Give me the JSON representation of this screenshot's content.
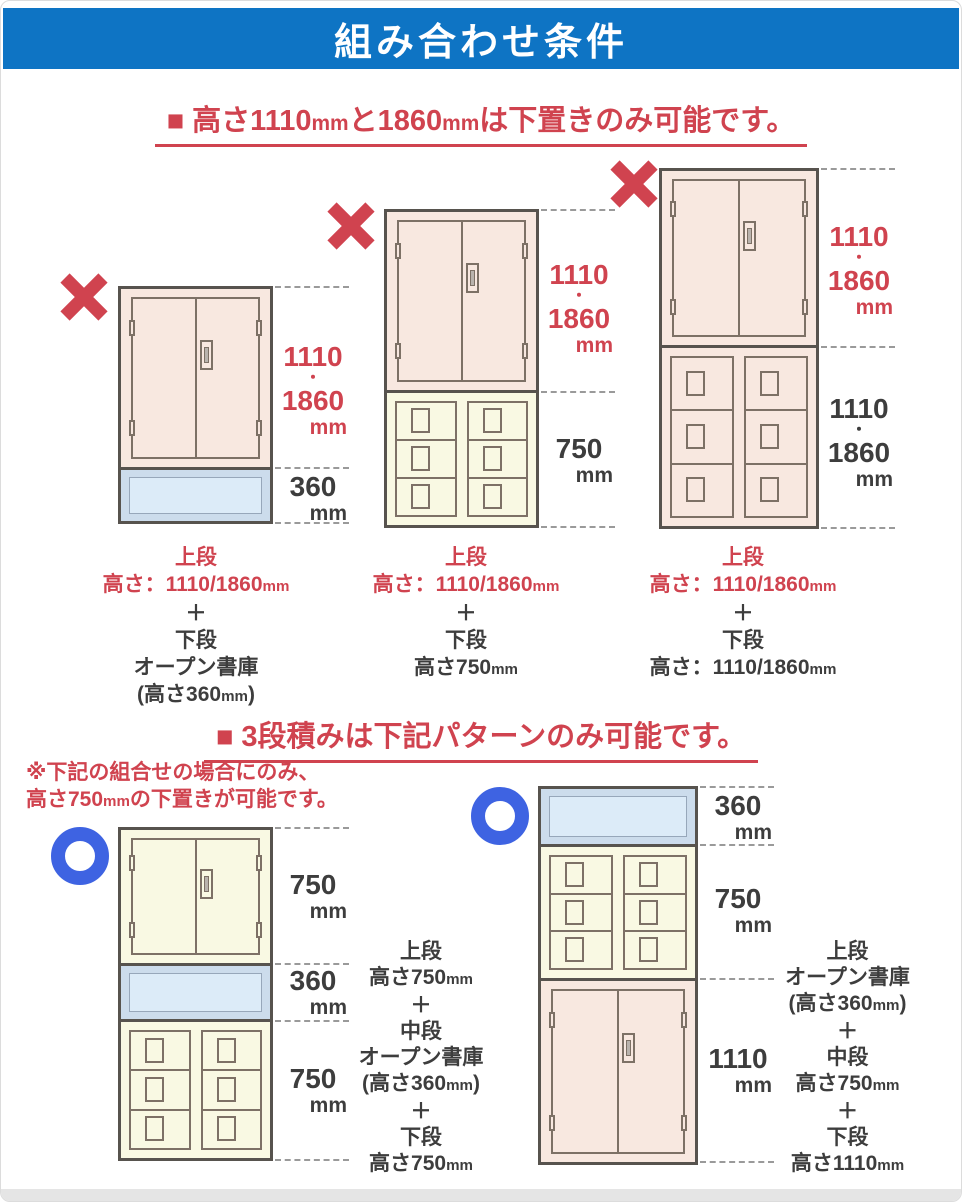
{
  "title": "組み合わせ条件",
  "colors": {
    "header_bg": "#0e74c4",
    "ng_red": "#d0434f",
    "ok_blue": "#3e63e2",
    "text_dark": "#3d3d3d"
  },
  "icons": {
    "ng_mark": "x-cross",
    "ok_mark": "circle-ring"
  },
  "section1": {
    "heading": "■ 高さ1110mmと1860mmは下置きのみ可能です。",
    "diagrams": [
      {
        "mark": "ng",
        "dims": [
          {
            "lines": [
              "1110",
              "・",
              "1860",
              "mm"
            ],
            "color": "red"
          },
          {
            "lines": [
              "360",
              "mm"
            ],
            "color": "dark"
          }
        ],
        "caption": [
          {
            "text": "上段",
            "color": "red"
          },
          {
            "text": "高さ：1110/1860mm",
            "color": "red"
          },
          {
            "text": "＋",
            "color": "dark"
          },
          {
            "text": "下段",
            "color": "dark"
          },
          {
            "text": "オープン書庫",
            "color": "dark"
          },
          {
            "text": "(高さ360mm)",
            "color": "dark"
          }
        ]
      },
      {
        "mark": "ng",
        "dims": [
          {
            "lines": [
              "1110",
              "・",
              "1860",
              "mm"
            ],
            "color": "red"
          },
          {
            "lines": [
              "750",
              "mm"
            ],
            "color": "dark"
          }
        ],
        "caption": [
          {
            "text": "上段",
            "color": "red"
          },
          {
            "text": "高さ：1110/1860mm",
            "color": "red"
          },
          {
            "text": "＋",
            "color": "dark"
          },
          {
            "text": "下段",
            "color": "dark"
          },
          {
            "text": "高さ750mm",
            "color": "dark"
          }
        ]
      },
      {
        "mark": "ng",
        "dims": [
          {
            "lines": [
              "1110",
              "・",
              "1860",
              "mm"
            ],
            "color": "red"
          },
          {
            "lines": [
              "1110",
              "・",
              "1860",
              "mm"
            ],
            "color": "dark"
          }
        ],
        "caption": [
          {
            "text": "上段",
            "color": "red"
          },
          {
            "text": "高さ：1110/1860mm",
            "color": "red"
          },
          {
            "text": "＋",
            "color": "dark"
          },
          {
            "text": "下段",
            "color": "dark"
          },
          {
            "text": "高さ：1110/1860mm",
            "color": "dark"
          }
        ]
      }
    ]
  },
  "section2": {
    "heading": "■ 3段積みは下記パターンのみ可能です。",
    "note": [
      "※下記の組合せの場合にのみ、",
      "高さ750mmの下置きが可能です。"
    ],
    "diagrams": [
      {
        "mark": "ok",
        "dims": [
          {
            "lines": [
              "750",
              "mm"
            ],
            "color": "dark"
          },
          {
            "lines": [
              "360",
              "mm"
            ],
            "color": "dark"
          },
          {
            "lines": [
              "750",
              "mm"
            ],
            "color": "dark"
          }
        ],
        "caption": [
          {
            "text": "上段",
            "color": "dark"
          },
          {
            "text": "高さ750mm",
            "color": "dark"
          },
          {
            "text": "＋",
            "color": "dark"
          },
          {
            "text": "中段",
            "color": "dark"
          },
          {
            "text": "オープン書庫",
            "color": "dark"
          },
          {
            "text": "(高さ360mm)",
            "color": "dark"
          },
          {
            "text": "＋",
            "color": "dark"
          },
          {
            "text": "下段",
            "color": "dark"
          },
          {
            "text": "高さ750mm",
            "color": "dark"
          }
        ]
      },
      {
        "mark": "ok",
        "dims": [
          {
            "lines": [
              "360",
              "mm"
            ],
            "color": "dark"
          },
          {
            "lines": [
              "750",
              "mm"
            ],
            "color": "dark"
          },
          {
            "lines": [
              "1110",
              "mm"
            ],
            "color": "dark"
          }
        ],
        "caption": [
          {
            "text": "上段",
            "color": "dark"
          },
          {
            "text": "オープン書庫",
            "color": "dark"
          },
          {
            "text": "(高さ360mm)",
            "color": "dark"
          },
          {
            "text": "＋",
            "color": "dark"
          },
          {
            "text": "中段",
            "color": "dark"
          },
          {
            "text": "高さ750mm",
            "color": "dark"
          },
          {
            "text": "＋",
            "color": "dark"
          },
          {
            "text": "下段",
            "color": "dark"
          },
          {
            "text": "高さ1110mm",
            "color": "dark"
          }
        ]
      }
    ]
  }
}
